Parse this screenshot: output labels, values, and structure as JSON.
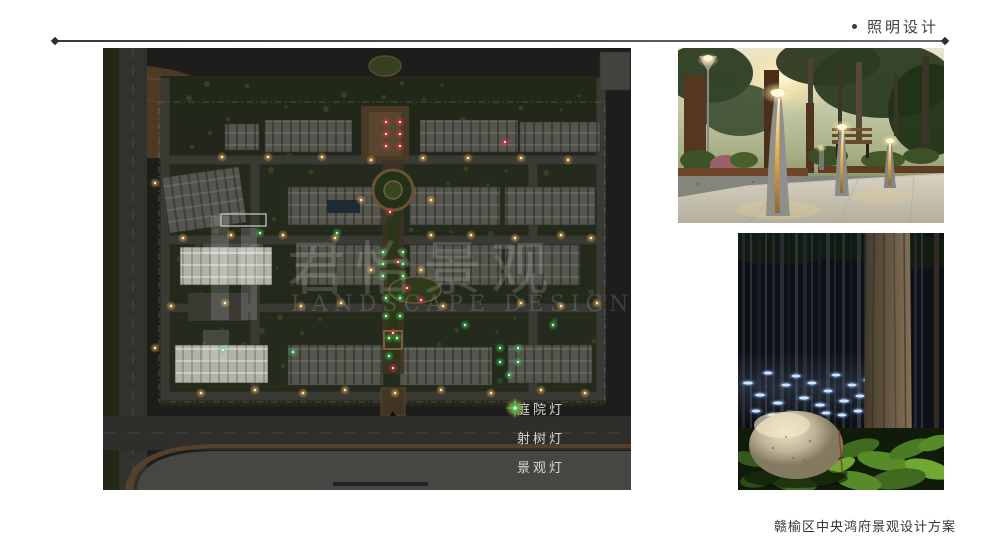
{
  "header": {
    "title": "照明设计"
  },
  "caption": "赣榆区中央鸿府景观设计方案",
  "watermark": {
    "cn": "君怡景观",
    "en": "LANDSCAPE DESIGN"
  },
  "legend": {
    "items": [
      {
        "id": "courtyard-light",
        "label": "庭院灯",
        "color": "#f0a030"
      },
      {
        "id": "tree-spotlight",
        "label": "射树灯",
        "color": "#e42840"
      },
      {
        "id": "landscape-light",
        "label": "景观灯",
        "color": "#2ecb48"
      }
    ]
  },
  "map": {
    "colors": {
      "courtyard": "#f5b544",
      "tree": "#ef3048",
      "landscape": "#3ad455"
    },
    "lights": {
      "courtyard": [
        [
          119,
          109
        ],
        [
          165,
          109
        ],
        [
          219,
          109
        ],
        [
          268,
          112
        ],
        [
          320,
          110
        ],
        [
          365,
          110
        ],
        [
          418,
          110
        ],
        [
          465,
          112
        ],
        [
          80,
          190
        ],
        [
          128,
          187
        ],
        [
          180,
          187
        ],
        [
          232,
          190
        ],
        [
          328,
          187
        ],
        [
          368,
          187
        ],
        [
          412,
          190
        ],
        [
          458,
          187
        ],
        [
          488,
          190
        ],
        [
          68,
          258
        ],
        [
          122,
          255
        ],
        [
          198,
          258
        ],
        [
          238,
          255
        ],
        [
          340,
          258
        ],
        [
          418,
          255
        ],
        [
          458,
          258
        ],
        [
          494,
          255
        ],
        [
          98,
          345
        ],
        [
          152,
          342
        ],
        [
          200,
          345
        ],
        [
          242,
          342
        ],
        [
          292,
          345
        ],
        [
          338,
          342
        ],
        [
          388,
          345
        ],
        [
          438,
          342
        ],
        [
          482,
          345
        ],
        [
          258,
          152
        ],
        [
          328,
          152
        ],
        [
          268,
          222
        ],
        [
          318,
          222
        ],
        [
          52,
          135
        ],
        [
          52,
          300
        ]
      ],
      "tree": [
        [
          283,
          74
        ],
        [
          297,
          74
        ],
        [
          283,
          86
        ],
        [
          297,
          86
        ],
        [
          283,
          98
        ],
        [
          297,
          98
        ],
        [
          287,
          164
        ],
        [
          295,
          214
        ],
        [
          304,
          240
        ],
        [
          318,
          252
        ],
        [
          290,
          285
        ],
        [
          402,
          94
        ],
        [
          290,
          320
        ]
      ],
      "landscape": [
        [
          280,
          204
        ],
        [
          300,
          204
        ],
        [
          280,
          216
        ],
        [
          300,
          216
        ],
        [
          280,
          228
        ],
        [
          300,
          228
        ],
        [
          283,
          250
        ],
        [
          297,
          250
        ],
        [
          283,
          268
        ],
        [
          297,
          268
        ],
        [
          286,
          290
        ],
        [
          294,
          290
        ],
        [
          157,
          185
        ],
        [
          234,
          185
        ],
        [
          362,
          277
        ],
        [
          450,
          277
        ],
        [
          397,
          300
        ],
        [
          397,
          314
        ],
        [
          406,
          327
        ],
        [
          415,
          300
        ],
        [
          415,
          314
        ],
        [
          120,
          302
        ],
        [
          190,
          304
        ],
        [
          286,
          308
        ]
      ]
    }
  }
}
